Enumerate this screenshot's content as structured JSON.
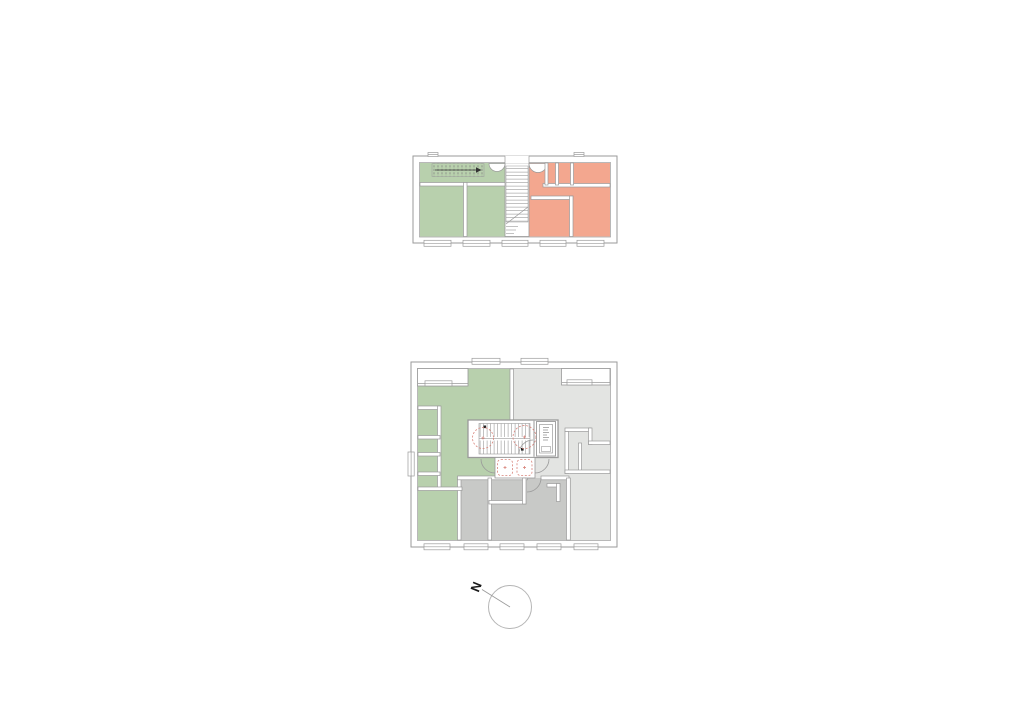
{
  "page": {
    "background": "#ffffff"
  },
  "colors": {
    "apartment_green": "#b8d0ad",
    "apartment_salmon": "#f3a78f",
    "apartment_light_gray": "#e3e4e2",
    "apartment_mid_gray": "#c8c9c7",
    "wall_line": "#9a9a9a",
    "turning_circle_red": "#d8837a"
  },
  "plans": [
    {
      "id": "upper-floor-plan",
      "position": "top",
      "zones": [
        "green-apartment",
        "salmon-apartment"
      ],
      "features": [
        "attic-stair-hatch",
        "central-stairwell",
        "door-swings",
        "window-markers"
      ]
    },
    {
      "id": "main-floor-plan",
      "position": "bottom",
      "zones": [
        "green-apartment",
        "light-gray-apartment",
        "mid-gray-apartment"
      ],
      "features": [
        "stair-core",
        "elevator",
        "turning-circles",
        "vestibule",
        "door-swings",
        "window-markers",
        "corner-loggias"
      ]
    }
  ],
  "compass": {
    "label": "N"
  }
}
